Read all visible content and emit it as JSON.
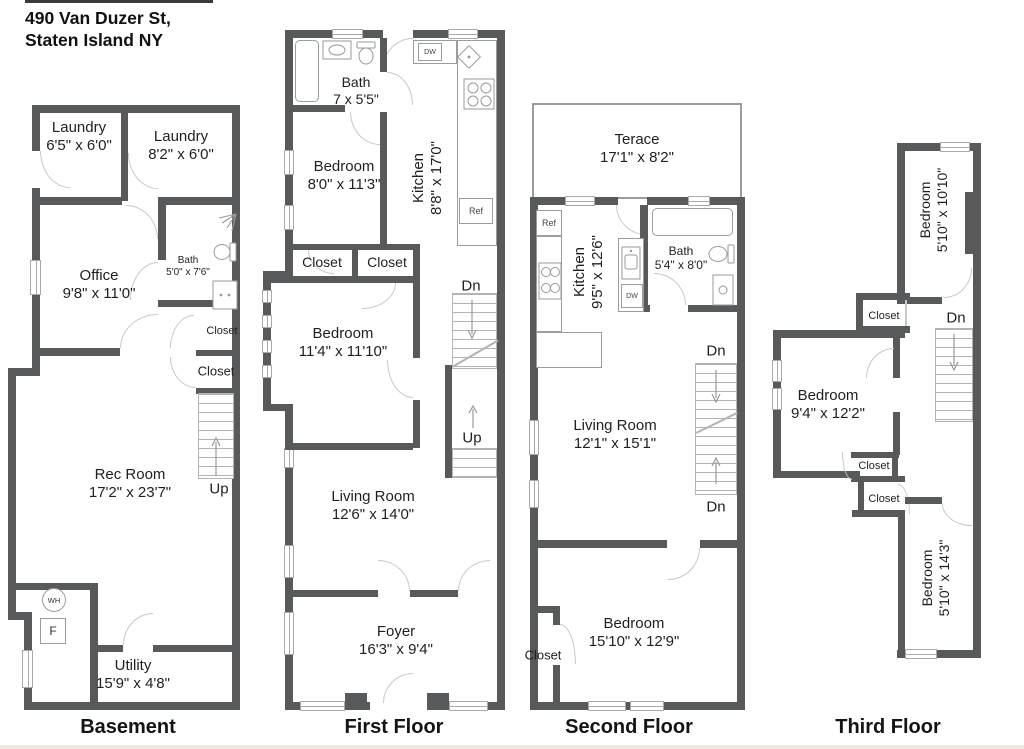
{
  "title": {
    "line1": "490 Van Duzer St,",
    "line2": "Staten Island NY"
  },
  "colors": {
    "wall": "#58595b",
    "door_arc": "#c9c9c9",
    "fixture_line": "#9a9a9a",
    "text": "#1f1f1f"
  },
  "floors": {
    "basement": {
      "label": "Basement",
      "laundry1": {
        "name": "Laundry",
        "dims": "6'5\" x 6'0\""
      },
      "laundry2": {
        "name": "Laundry",
        "dims": "8'2\" x 6'0\""
      },
      "office": {
        "name": "Office",
        "dims": "9'8\" x 11'0\""
      },
      "bath": {
        "name": "Bath",
        "dims": "5'0\" x 7'6\""
      },
      "closet1": "Closet",
      "closet2": "Closet",
      "rec": {
        "name": "Rec Room",
        "dims": "17'2\" x 23'7\""
      },
      "utility": {
        "name": "Utility",
        "dims": "15'9\" x 4'8\""
      },
      "up": "Up",
      "wh": "WH",
      "f": "F"
    },
    "first": {
      "label": "First Floor",
      "bath": {
        "name": "Bath",
        "dims": "7 x 5'5\""
      },
      "bedroom1": {
        "name": "Bedroom",
        "dims": "8'0\" x 11'3\""
      },
      "kitchen": {
        "name": "Kitchen",
        "dims": "8'8\" x 17'0\""
      },
      "closet1": "Closet",
      "closet2": "Closet",
      "bedroom2": {
        "name": "Bedroom",
        "dims": "11'4\" x 11'10\""
      },
      "living": {
        "name": "Living Room",
        "dims": "12'6\" x 14'0\""
      },
      "foyer": {
        "name": "Foyer",
        "dims": "16'3\" x 9'4\""
      },
      "dn": "Dn",
      "up": "Up",
      "dw": "DW",
      "ref": "Ref"
    },
    "second": {
      "label": "Second Floor",
      "terrace": {
        "name": "Terace",
        "dims": "17'1\" x 8'2\""
      },
      "kitchen": {
        "name": "Kitchen",
        "dims": "9'5\" x 12'6\""
      },
      "bath": {
        "name": "Bath",
        "dims": "5'4\" x 8'0\""
      },
      "living": {
        "name": "Living Room",
        "dims": "12'1\" x 15'1\""
      },
      "bedroom": {
        "name": "Bedroom",
        "dims": "15'10\" x 12'9\""
      },
      "closet": "Closet",
      "dn_top": "Dn",
      "dn_bottom": "Dn",
      "ref": "Ref",
      "dw": "DW"
    },
    "third": {
      "label": "Third Floor",
      "bedroom1": {
        "name": "Bedroom",
        "dims": "5'10\" x 10'10\""
      },
      "bedroom2": {
        "name": "Bedroom",
        "dims": "9'4\" x 12'2\""
      },
      "bedroom3": {
        "name": "Bedroom",
        "dims": "5'10\" x 14'3\""
      },
      "closet1": "Closet",
      "closet2": "Closet",
      "closet3": "Closet",
      "dn": "Dn"
    }
  }
}
